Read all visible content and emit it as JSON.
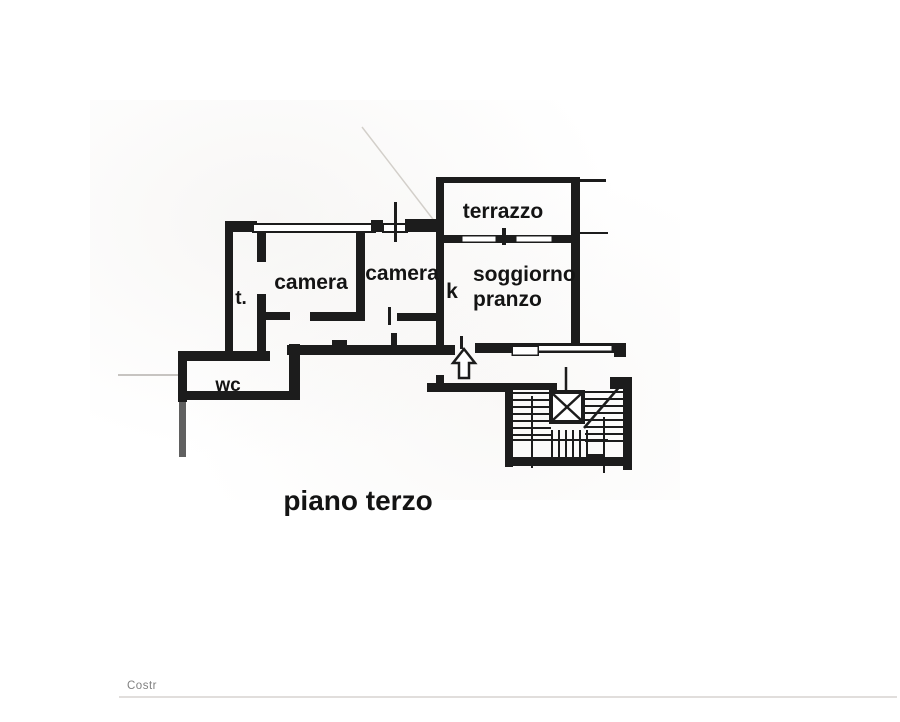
{
  "colors": {
    "ink": "#1c1c1c",
    "paper": "#ffffff",
    "faint_line": "#beb9b1"
  },
  "plan": {
    "rooms": [
      {
        "id": "terrazzo",
        "label": "terrazzo"
      },
      {
        "id": "camera-left",
        "label": "camera"
      },
      {
        "id": "camera-right",
        "label": "camera"
      },
      {
        "id": "kitchen",
        "label": "k"
      },
      {
        "id": "soggiorno-pranzo",
        "line1": "soggiorno",
        "line2": "pranzo"
      },
      {
        "id": "terrace-small",
        "label": "t."
      },
      {
        "id": "wc",
        "label": "wc"
      }
    ],
    "caption": "piano terzo",
    "symbols": {
      "entrance_arrow": "hollow-up-arrow",
      "elevator": "x-crossed-shaft",
      "stairs": "double-flight-with-treads"
    }
  },
  "footer": {
    "partial_text": "Costr"
  }
}
